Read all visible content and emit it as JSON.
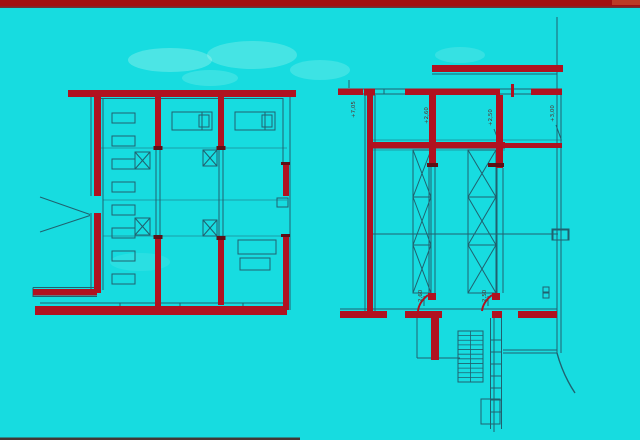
{
  "slide": {
    "kind": "architectural-floor-plan-slide",
    "width": 640,
    "height": 440
  },
  "palette": {
    "background": "#17dce0",
    "wall_red": "#b01220",
    "cap_dark": "#5e1016",
    "line_teal": "#20616f",
    "band_red": "#a21010",
    "band_underline": "#7e0c0c",
    "band_tail": "#c04028",
    "bottom_strip": "#4a1b15",
    "smudge": "#d9fff4",
    "annotation_text": "#5a2a26"
  },
  "frame": {
    "top_band": [
      0,
      0,
      640,
      6.5
    ],
    "top_band_underline": [
      0,
      6.5,
      640,
      1.5
    ],
    "top_band_tail": [
      612,
      0,
      28,
      5
    ],
    "bottom_strip": [
      0,
      437.5,
      300,
      2.5
    ]
  },
  "smudges": [
    [
      170,
      60,
      42,
      12,
      0.28
    ],
    [
      252,
      55,
      45,
      14,
      0.24
    ],
    [
      320,
      70,
      30,
      10,
      0.2
    ],
    [
      460,
      55,
      25,
      8,
      0.16
    ],
    [
      210,
      78,
      28,
      8,
      0.18
    ],
    [
      140,
      262,
      30,
      9,
      0.1
    ]
  ],
  "plans": {
    "left": {
      "red_rects": [
        [
          68,
          90,
          228,
          7
        ],
        [
          94,
          96,
          7,
          100
        ],
        [
          94,
          213,
          7,
          80
        ],
        [
          33,
          289,
          64,
          6.5
        ],
        [
          35,
          306,
          252,
          9
        ],
        [
          155,
          96,
          6,
          52
        ],
        [
          155,
          237,
          6,
          70
        ],
        [
          218,
          96,
          6,
          52
        ],
        [
          218,
          238,
          6,
          67
        ],
        [
          283,
          163,
          6,
          33
        ],
        [
          283,
          236,
          6,
          74
        ]
      ],
      "dark_rects": [
        [
          153.5,
          146,
          9,
          4
        ],
        [
          216.5,
          146,
          9,
          4
        ],
        [
          153.5,
          235,
          9,
          4
        ],
        [
          216.5,
          236,
          9,
          4
        ],
        [
          281,
          162,
          9,
          3
        ],
        [
          281,
          234,
          9,
          3
        ]
      ],
      "lines": [
        [
          101,
          98.5,
          283,
          98.5
        ],
        [
          103,
          98,
          103,
          290
        ],
        [
          91,
          96,
          91,
          196
        ],
        [
          91,
          213,
          91,
          290
        ],
        [
          290,
          96,
          290,
          310
        ],
        [
          283,
          98,
          283,
          162
        ],
        [
          40,
          303,
          285,
          303
        ],
        [
          120,
          303,
          120,
          306
        ],
        [
          180,
          303,
          180,
          306
        ],
        [
          243,
          303,
          243,
          306
        ],
        [
          33,
          287.5,
          97,
          287.5
        ],
        [
          33,
          296.5,
          97,
          296.5
        ],
        [
          33,
          287.5,
          33,
          297
        ],
        [
          40,
          197,
          90,
          214.5
        ],
        [
          40,
          232,
          90,
          215.5
        ],
        [
          156,
          148,
          156,
          237
        ],
        [
          160,
          148,
          160,
          237
        ],
        [
          219,
          148,
          219,
          238
        ],
        [
          223,
          148,
          223,
          238
        ],
        [
          202,
          112,
          202,
          130
        ],
        [
          265,
          112,
          265,
          130
        ]
      ],
      "flines": [
        [
          101,
          148,
          287,
          148
        ],
        [
          103,
          200,
          287,
          200
        ],
        [
          103,
          236,
          287,
          236
        ]
      ],
      "thin_rects": [
        [
          172,
          112,
          40,
          18
        ],
        [
          235,
          112,
          40,
          18
        ],
        [
          199,
          115,
          10,
          12
        ],
        [
          262,
          115,
          10,
          12
        ],
        [
          277,
          198,
          11,
          9
        ],
        [
          112,
          113,
          23,
          10
        ],
        [
          112,
          136,
          23,
          10
        ],
        [
          112,
          159,
          23,
          10
        ],
        [
          112,
          182,
          23,
          10
        ],
        [
          112,
          205,
          23,
          10
        ],
        [
          112,
          228,
          23,
          10
        ],
        [
          112,
          251,
          23,
          10
        ],
        [
          112,
          274,
          23,
          10
        ],
        [
          238,
          240,
          38,
          14
        ],
        [
          240,
          258,
          30,
          12
        ]
      ],
      "x_boxes": [
        [
          135,
          152,
          15,
          17
        ],
        [
          203,
          150,
          14,
          16
        ],
        [
          135,
          218,
          15,
          17
        ],
        [
          203,
          220,
          14,
          16
        ]
      ],
      "red_paths": [],
      "stairs": []
    },
    "right": {
      "red_rects": [
        [
          432,
          65,
          131,
          7
        ],
        [
          338,
          88.5,
          25,
          6.5
        ],
        [
          364,
          88.5,
          11,
          7
        ],
        [
          405,
          88.5,
          95,
          6.5
        ],
        [
          531,
          88.5,
          31,
          6.5
        ],
        [
          511,
          84,
          3,
          13
        ],
        [
          367,
          95,
          6,
          218
        ],
        [
          429,
          95,
          7,
          72
        ],
        [
          496,
          95,
          7,
          73
        ],
        [
          373,
          142,
          132,
          6.5
        ],
        [
          505,
          143,
          57,
          5
        ],
        [
          340,
          311,
          47,
          7
        ],
        [
          405,
          311,
          37,
          7
        ],
        [
          428,
          311,
          14,
          7
        ],
        [
          492,
          311,
          10,
          7
        ],
        [
          518,
          311,
          39,
          7
        ],
        [
          428,
          293,
          8,
          7
        ],
        [
          492,
          293,
          8,
          7
        ],
        [
          431,
          318,
          8,
          42
        ]
      ],
      "dark_rects": [
        [
          427,
          163,
          11,
          4
        ],
        [
          488,
          163,
          16,
          4
        ]
      ],
      "lines": [
        [
          557,
          17,
          557,
          353
        ],
        [
          561,
          95,
          561,
          353
        ],
        [
          432,
          74,
          557,
          74
        ],
        [
          363,
          89,
          405,
          89
        ],
        [
          363,
          94,
          405,
          94
        ],
        [
          500,
          89,
          531,
          89
        ],
        [
          500,
          94,
          531,
          94
        ],
        [
          384,
          89,
          384,
          94.5
        ],
        [
          349,
          80,
          349,
          88
        ],
        [
          365,
          95,
          365,
          311
        ],
        [
          375,
          95,
          375,
          311
        ],
        [
          429,
          167,
          429,
          293
        ],
        [
          435,
          167,
          435,
          293
        ],
        [
          497,
          168,
          497,
          293
        ],
        [
          503,
          168,
          503,
          293
        ],
        [
          373,
          234,
          558,
          234
        ],
        [
          340,
          309,
          557,
          309
        ],
        [
          417,
          318,
          417,
          358
        ],
        [
          417,
          358,
          460,
          358
        ],
        [
          503,
          350,
          557,
          350
        ],
        [
          503,
          353,
          557,
          353
        ],
        [
          490.5,
          318,
          490.5,
          429
        ],
        [
          501.5,
          318,
          501.5,
          429
        ],
        [
          494,
          318,
          494,
          432
        ],
        [
          490.5,
          340,
          501.5,
          340
        ],
        [
          490.5,
          352,
          501.5,
          352
        ],
        [
          490.5,
          364,
          501.5,
          364
        ],
        [
          490.5,
          376,
          501.5,
          376
        ],
        [
          490.5,
          388,
          501.5,
          388
        ],
        [
          490.5,
          400,
          501.5,
          400
        ],
        [
          490.5,
          412,
          501.5,
          412
        ],
        [
          430,
          127,
          435,
          141
        ],
        [
          494,
          129,
          499,
          142
        ],
        [
          556,
          125,
          561,
          139
        ],
        [
          424,
          296,
          424,
          306
        ],
        [
          488,
          296,
          488,
          306
        ]
      ],
      "flines": [
        [
          373,
          140,
          562,
          140
        ],
        [
          373,
          150,
          505,
          150
        ]
      ],
      "thin_rects": [
        [
          552,
          229,
          17,
          11
        ],
        [
          553,
          230,
          15,
          10
        ],
        [
          481,
          399,
          19,
          25
        ],
        [
          543,
          287,
          6,
          5
        ],
        [
          543,
          293,
          6,
          5
        ]
      ],
      "x_boxes": [
        [
          413,
          150,
          18,
          47
        ],
        [
          413,
          197,
          18,
          48
        ],
        [
          413,
          245,
          18,
          48
        ],
        [
          468,
          150,
          28,
          47
        ],
        [
          468,
          197,
          28,
          48
        ],
        [
          468,
          245,
          28,
          48
        ]
      ],
      "red_paths": [
        "M 428 295 q -9 7 -10 16",
        "M 492 295 q -9 7 -10 16"
      ],
      "stairs": [
        {
          "x": 458,
          "y": 331,
          "w": 25,
          "h": 51,
          "treads": 10
        }
      ],
      "curve": "M 557 353 Q 563 375 575 393"
    }
  },
  "annotations": [
    {
      "text": "+7,05",
      "x": 355,
      "y": 118,
      "rot": -90
    },
    {
      "text": "+2,60",
      "x": 428,
      "y": 124,
      "rot": -90
    },
    {
      "text": "+2,50",
      "x": 492,
      "y": 126,
      "rot": -90
    },
    {
      "text": "+3,00",
      "x": 554,
      "y": 122,
      "rot": -90
    },
    {
      "text": "2,60",
      "x": 422,
      "y": 302,
      "rot": -90
    },
    {
      "text": "2,50",
      "x": 486,
      "y": 302,
      "rot": -90
    }
  ]
}
